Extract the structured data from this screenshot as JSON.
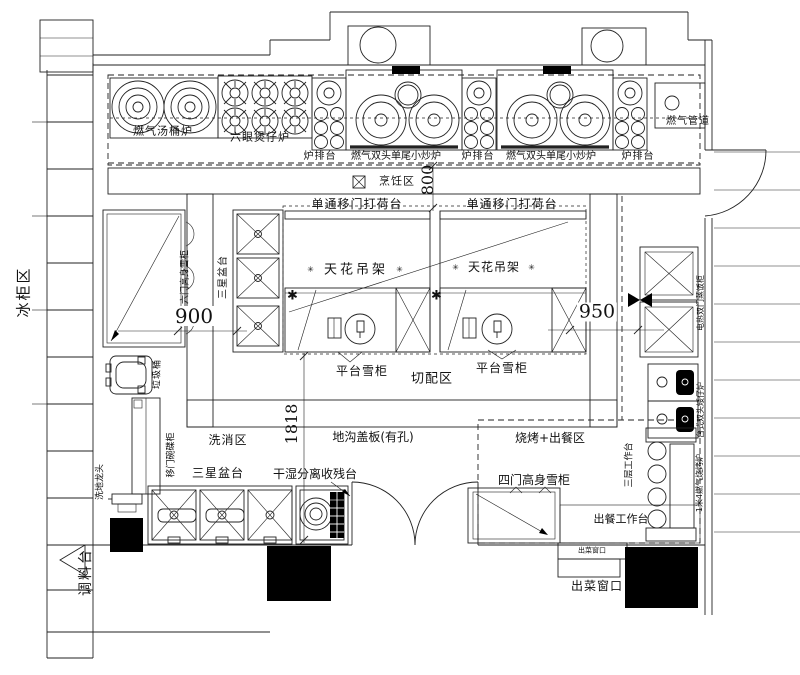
{
  "title": "厨房设备平面布置图",
  "zones": {
    "freezer_zone": "冰柜区",
    "seasoning_zone": "调料台",
    "cooking_zone": "烹饪区",
    "cutting_zone": "切配区",
    "wash_zone": "洗消区",
    "bbq_serving_zone": "烧烤+出餐区"
  },
  "labels": {
    "soup_stove": "燃气汤桶炉",
    "claypot_stove": "六眼煲仔炉",
    "stand1": "炉排台",
    "wok1": "燃气双头单尾小炒炉",
    "stand2": "炉排台",
    "wok2": "燃气双头单尾小炒炉",
    "stand3": "炉排台",
    "gas_pipe": "燃气管道",
    "pass_counter_left": "单通移门打荷台",
    "pass_counter_right": "单通移门打荷台",
    "ceiling_rack_left": "天花吊架",
    "ceiling_rack_right": "天花吊架",
    "platform_fridge_left": "平台雪柜",
    "platform_fridge_right": "平台雪柜",
    "island_star_sink": "三星盆台",
    "tall_fridge6": "六门高身雪柜",
    "trash_bin": "垃圾桶",
    "dish_cabinet": "移门碗碟柜",
    "floor_tap": "洗地龙头",
    "drain_cover": "地沟盖板(有孔)",
    "bottom_star_sink": "三星盆台",
    "waste_table": "干湿分离收残台",
    "tall_fridge4": "四门高身雪柜",
    "serving_table": "出餐工作台",
    "serving_window_small": "出菜窗口",
    "serving_window": "出菜窗口",
    "three_tier_table": "三层工作台",
    "rice_steamer": "电热双门蒸饭柜",
    "low_stove": "台式双头矮仔炉",
    "bbq_grill": "1米4燃气烧烤炉"
  },
  "dimensions": {
    "aisle_top": "800",
    "aisle_left": "900",
    "aisle_right": "950",
    "span_bottom": "1818"
  },
  "deco": {
    "star": "✳",
    "bold_star": "✱"
  },
  "colors": {
    "line": "#222222",
    "fill_black": "#000000",
    "background": "#ffffff"
  }
}
